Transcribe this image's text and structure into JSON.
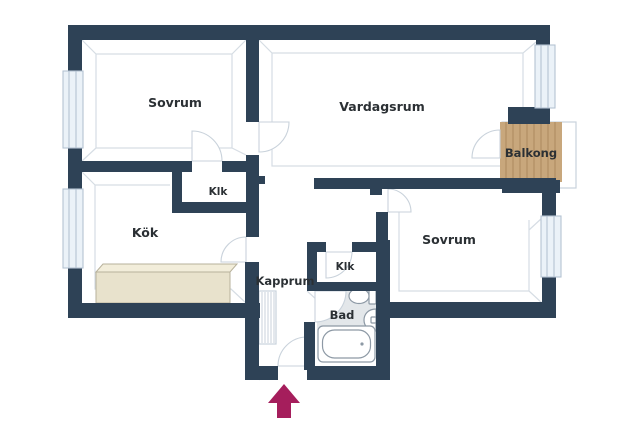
{
  "colors": {
    "wall": "#2e4256",
    "outline": "#c9d2db",
    "inner_line": "#d6dde4",
    "window_fill": "#ebf2f8",
    "window_stroke": "#b4c3d2",
    "balcony_wood": "#c8a77c",
    "balcony_wood_line": "#ab8a5e",
    "counter_front": "#e8e2cc",
    "counter_top": "#f2edda",
    "counter_stroke": "#b7b19b",
    "bath_floor": "#e3e7ea",
    "fixture_stroke": "#8d99a5",
    "entrance_arrow": "#a51e5c",
    "label_text": "#2b3034"
  },
  "rooms": [
    {
      "id": "sovrum-1",
      "label": "Sovrum"
    },
    {
      "id": "vardagsrum",
      "label": "Vardagsrum"
    },
    {
      "id": "balkong",
      "label": "Balkong"
    },
    {
      "id": "klk-1",
      "label": "Klk"
    },
    {
      "id": "kok",
      "label": "Kök"
    },
    {
      "id": "sovrum-2",
      "label": "Sovrum"
    },
    {
      "id": "kapprum",
      "label": "Kapprum"
    },
    {
      "id": "klk-2",
      "label": "Klk"
    },
    {
      "id": "bad",
      "label": "Bad"
    }
  ],
  "entrance": {
    "indicator": "up-arrow"
  }
}
